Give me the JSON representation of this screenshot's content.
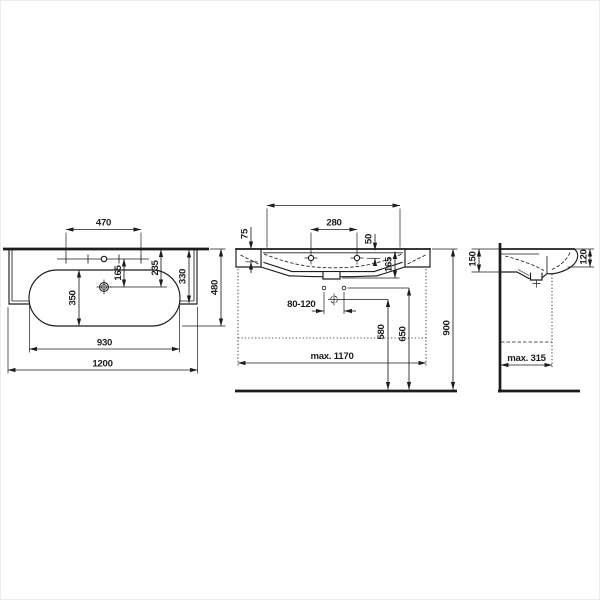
{
  "colors": {
    "background": "#ffffff",
    "line": "#1d1d1b"
  },
  "views": {
    "top": {
      "dims": {
        "tap_spread": "470",
        "tap_row_to_drain": "165",
        "back_to_drain": "235",
        "back_to_front_edge": "330",
        "total_depth": "480",
        "bowl_depth": "350",
        "bowl_width": "930",
        "overall_width": "1200"
      }
    },
    "front": {
      "dims": {
        "tap_holes_spread": "280",
        "rim_to_tap_hole": "50",
        "rim_thickness": "75",
        "rim_to_outlet": "165",
        "supply_spacing": "80-120",
        "floor_to_waste": "580",
        "floor_to_supply": "650",
        "floor_to_rim": "900",
        "max_width": "max. 1170"
      }
    },
    "side": {
      "dims": {
        "back_height": "150",
        "front_height": "120",
        "max_depth": "max. 315"
      }
    }
  },
  "symbols": {
    "wall": "wall-section-line",
    "floor": "floor-line",
    "faucet_hole": "faucet-hole-marker",
    "drain": "drain-outlet-symbol",
    "waste_trap": "waste-trap-crosshair",
    "supply": "supply-connection-hole",
    "hidden_contour": "dashed-hidden-line",
    "furniture_zone": "dotted-clearance-line"
  }
}
